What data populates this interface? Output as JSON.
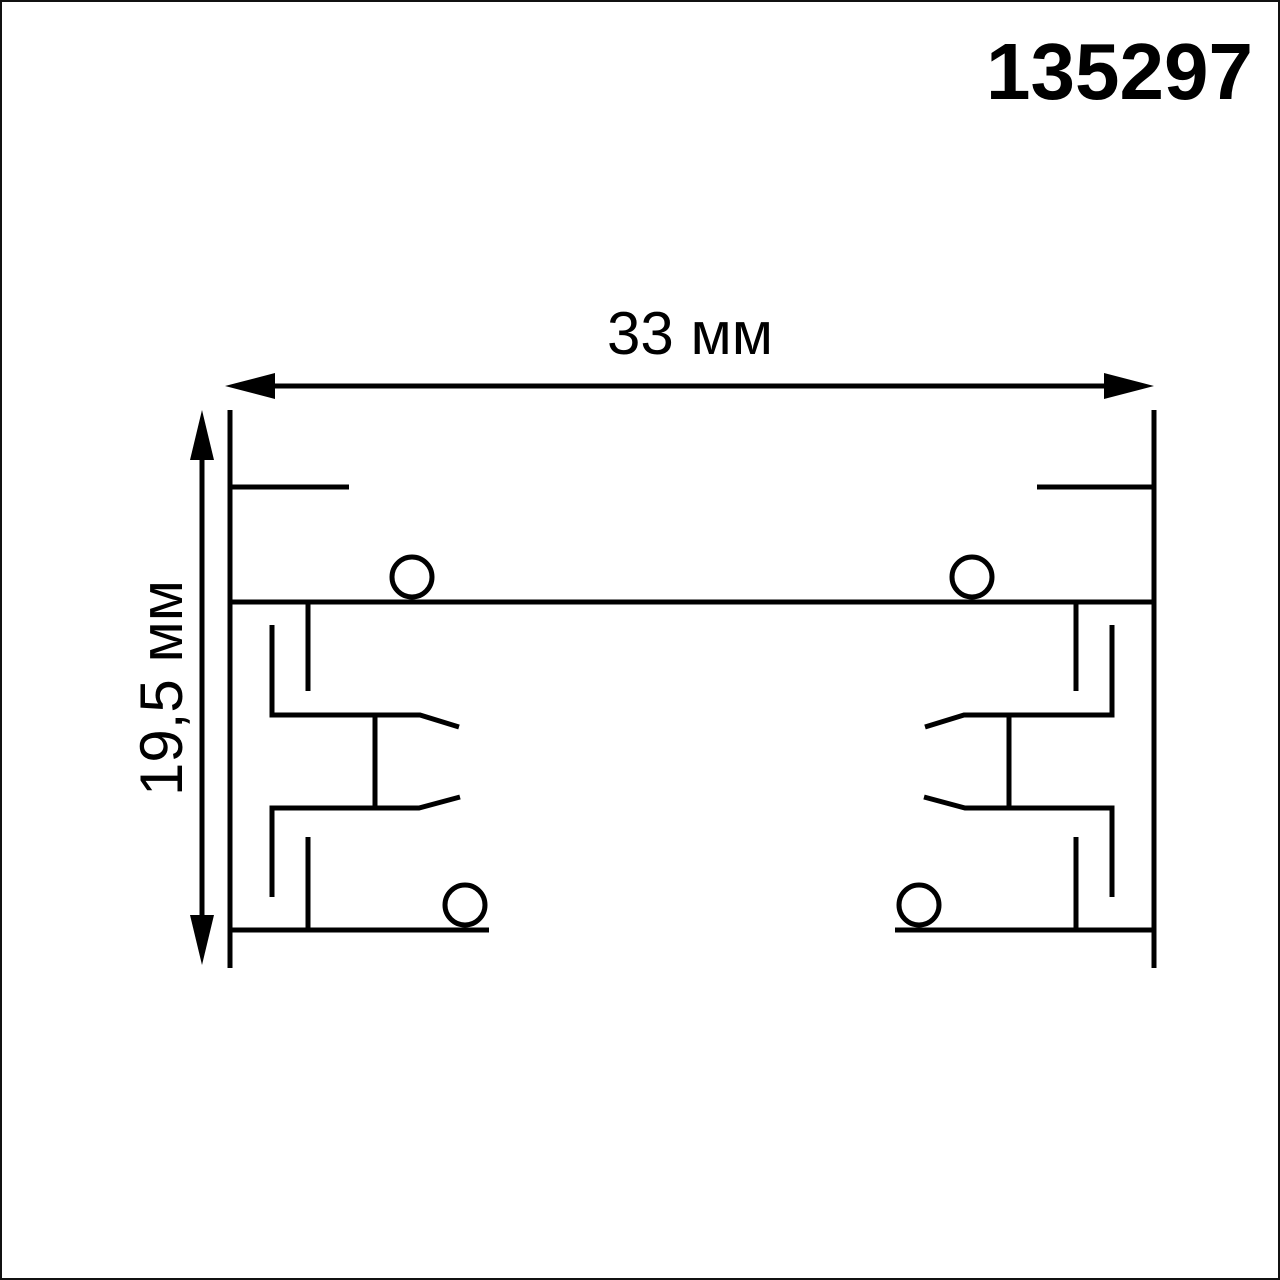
{
  "title": "Track profile cross-section technical drawing",
  "product_code": "135297",
  "dimensions": {
    "width_label": "33 мм",
    "width_value_mm": 33,
    "height_label": "19,5 мм",
    "height_value_mm": 19.5
  },
  "colors": {
    "line": "#000000",
    "background": "#ffffff",
    "page_border": "#111111"
  }
}
